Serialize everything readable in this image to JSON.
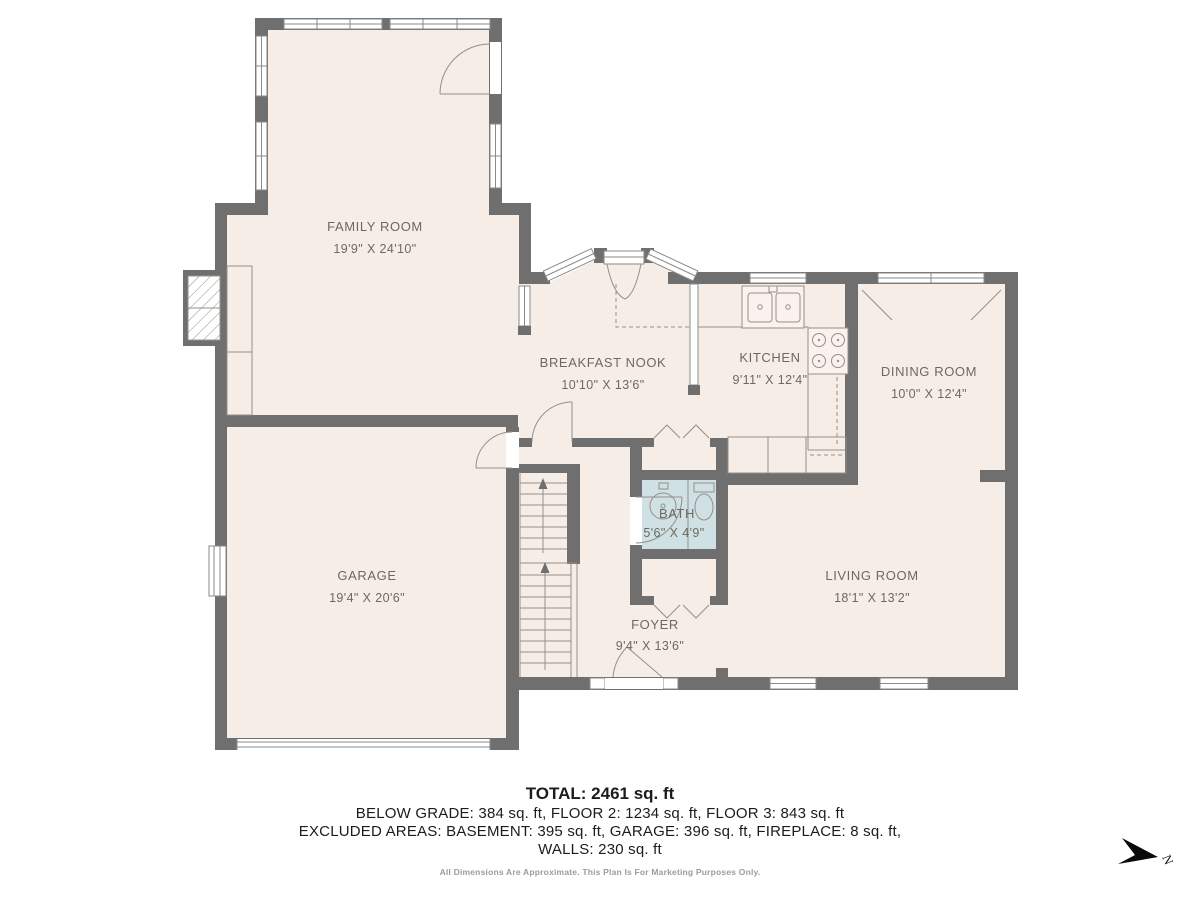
{
  "colors": {
    "wall": "#6f6f6f",
    "floor": "#f7ede7",
    "bathfloor": "#cfe1e4",
    "line": "#968e87",
    "winstroke": "#8a8a8a",
    "label": "#6e6862",
    "summary": "#1c1c1c",
    "muted": "#9c9c9c",
    "compass": "#0a0a0a"
  },
  "plan": {
    "rooms": [
      {
        "name": "FAMILY ROOM",
        "dims": "19'9\" X 24'10\""
      },
      {
        "name": "BREAKFAST NOOK",
        "dims": "10'10\" X 13'6\""
      },
      {
        "name": "KITCHEN",
        "dims": "9'11\" X 12'4\""
      },
      {
        "name": "DINING ROOM",
        "dims": "10'0\" X 12'4\""
      },
      {
        "name": "GARAGE",
        "dims": "19'4\" X 20'6\""
      },
      {
        "name": "BATH",
        "dims": "5'6\" X 4'9\""
      },
      {
        "name": "FOYER",
        "dims": "9'4\" X 13'6\""
      },
      {
        "name": "LIVING ROOM",
        "dims": "18'1\" X 13'2\""
      }
    ],
    "compass_label": "N"
  },
  "summary": {
    "total": "TOTAL: 2461 sq. ft",
    "breakdown": "BELOW GRADE: 384 sq. ft, FLOOR 2: 1234 sq. ft, FLOOR 3: 843 sq. ft",
    "excluded": "EXCLUDED AREAS: BASEMENT: 395 sq. ft, GARAGE: 396 sq. ft, FIREPLACE: 8 sq. ft,",
    "walls": "WALLS: 230 sq. ft",
    "disclaimer": "All Dimensions Are Approximate. This Plan Is For Marketing Purposes Only."
  }
}
